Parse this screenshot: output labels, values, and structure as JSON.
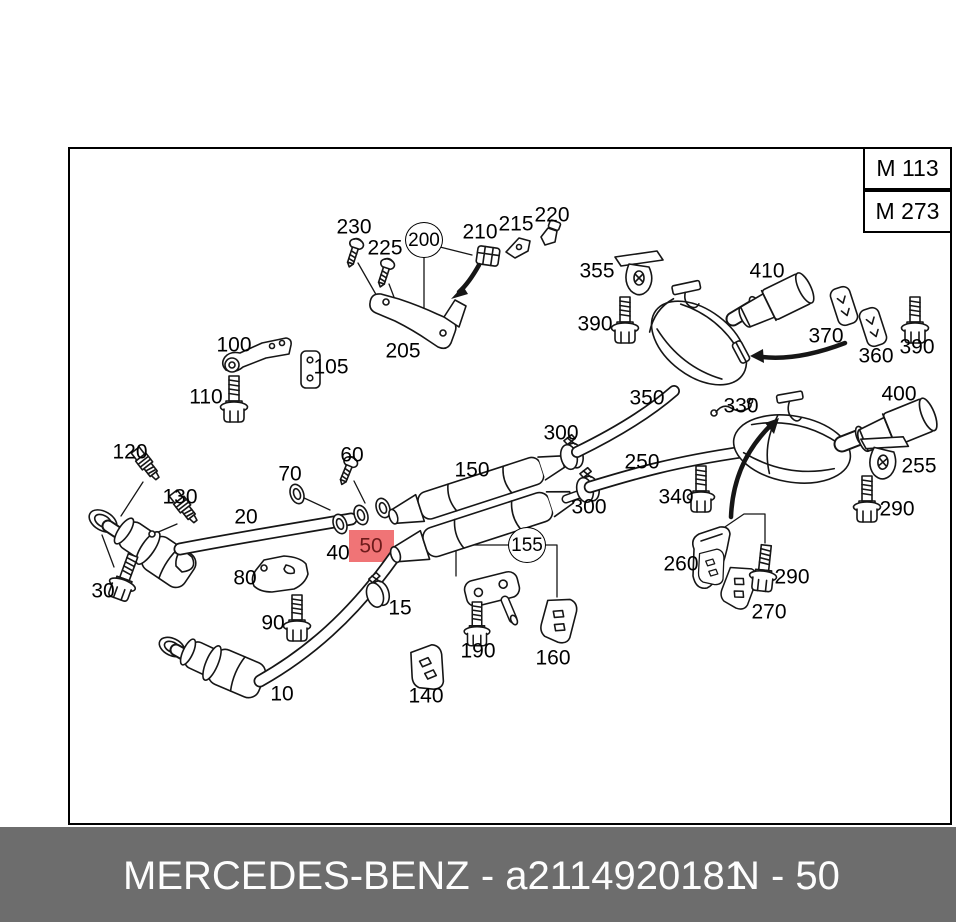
{
  "header": {
    "engine_codes": [
      "M 113",
      "M 273"
    ]
  },
  "footer": {
    "left_text": "MERCEDES-BENZ - a2114920181",
    "right_text": "N - 50"
  },
  "diagram": {
    "description": "Exploded exhaust system parts diagram",
    "highlighted_part": "50",
    "highlight_color": "#f07476",
    "highlight_text_color": "#6e1b1b",
    "labels": [
      {
        "text": "230",
        "x": 354,
        "y": 227
      },
      {
        "text": "225",
        "x": 385,
        "y": 248
      },
      {
        "text": "200",
        "x": 424,
        "y": 240,
        "kind": "circled"
      },
      {
        "text": "210",
        "x": 480,
        "y": 232
      },
      {
        "text": "215",
        "x": 516,
        "y": 224
      },
      {
        "text": "220",
        "x": 552,
        "y": 215
      },
      {
        "text": "205",
        "x": 403,
        "y": 351
      },
      {
        "text": "100",
        "x": 234,
        "y": 345
      },
      {
        "text": "105",
        "x": 331,
        "y": 367
      },
      {
        "text": "110",
        "x": 206,
        "y": 397
      },
      {
        "text": "120",
        "x": 130,
        "y": 452
      },
      {
        "text": "130",
        "x": 180,
        "y": 497
      },
      {
        "text": "20",
        "x": 246,
        "y": 517
      },
      {
        "text": "70",
        "x": 290,
        "y": 474
      },
      {
        "text": "60",
        "x": 352,
        "y": 455
      },
      {
        "text": "40",
        "x": 338,
        "y": 553
      },
      {
        "text": "50",
        "x": 371,
        "y": 546,
        "kind": "highlight"
      },
      {
        "text": "30",
        "x": 103,
        "y": 591
      },
      {
        "text": "80",
        "x": 245,
        "y": 578
      },
      {
        "text": "90",
        "x": 273,
        "y": 623
      },
      {
        "text": "10",
        "x": 282,
        "y": 694
      },
      {
        "text": "15",
        "x": 400,
        "y": 608
      },
      {
        "text": "140",
        "x": 426,
        "y": 696
      },
      {
        "text": "190",
        "x": 478,
        "y": 651
      },
      {
        "text": "160",
        "x": 553,
        "y": 658
      },
      {
        "text": "155",
        "x": 527,
        "y": 545,
        "kind": "circled"
      },
      {
        "text": "150",
        "x": 472,
        "y": 470
      },
      {
        "text": "300",
        "x": 561,
        "y": 433
      },
      {
        "text": "300",
        "x": 589,
        "y": 507
      },
      {
        "text": "250",
        "x": 642,
        "y": 462
      },
      {
        "text": "340",
        "x": 676,
        "y": 497
      },
      {
        "text": "350",
        "x": 647,
        "y": 398
      },
      {
        "text": "330",
        "x": 741,
        "y": 406
      },
      {
        "text": "355",
        "x": 597,
        "y": 271
      },
      {
        "text": "390",
        "x": 595,
        "y": 324
      },
      {
        "text": "410",
        "x": 767,
        "y": 271
      },
      {
        "text": "370",
        "x": 826,
        "y": 336
      },
      {
        "text": "360",
        "x": 876,
        "y": 356
      },
      {
        "text": "390",
        "x": 917,
        "y": 347
      },
      {
        "text": "400",
        "x": 899,
        "y": 394
      },
      {
        "text": "255",
        "x": 919,
        "y": 466
      },
      {
        "text": "290",
        "x": 897,
        "y": 509
      },
      {
        "text": "290",
        "x": 792,
        "y": 577
      },
      {
        "text": "260",
        "x": 681,
        "y": 564
      },
      {
        "text": "270",
        "x": 769,
        "y": 612
      }
    ]
  }
}
